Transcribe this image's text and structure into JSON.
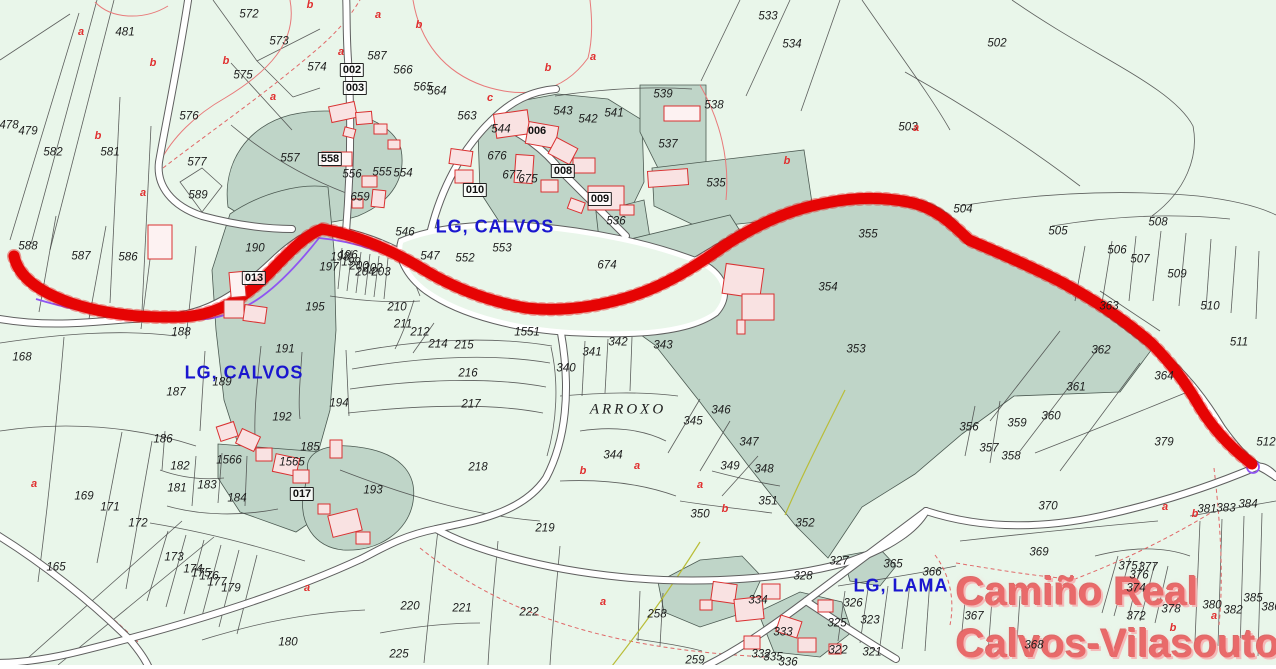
{
  "map": {
    "colors": {
      "background": "#e9f6ea",
      "parcel_dark": "#bfd5c8",
      "route_red": "#e60404",
      "gps_track_purple": "#8f55f2",
      "road_fill": "#ffffff",
      "parcel_label": "#1d1d1d",
      "subparcel_letter": "#e03030",
      "place_label_blue": "#1a16cf",
      "title_pink": "#e96a6a",
      "building_fill": "#f9e2e2",
      "building_stroke": "#d93131"
    },
    "place_labels": [
      {
        "text": "LG, CALVOS",
        "x": 495,
        "y": 227
      },
      {
        "text": "LG, CALVOS",
        "x": 244,
        "y": 373
      },
      {
        "text": "LG, LAMA",
        "x": 901,
        "y": 586
      }
    ],
    "area_label": {
      "text": "ARROXO",
      "x": 628,
      "y": 410
    },
    "title_overlay": {
      "line1": "Camiño Real",
      "line2": "Calvos-Vilasouto"
    },
    "parcel_labels": [
      {
        "t": "481",
        "x": 125,
        "y": 33
      },
      {
        "t": "572",
        "x": 249,
        "y": 15
      },
      {
        "t": "573",
        "x": 279,
        "y": 42
      },
      {
        "t": "575",
        "x": 243,
        "y": 76
      },
      {
        "t": "576",
        "x": 189,
        "y": 117
      },
      {
        "t": "577",
        "x": 197,
        "y": 163
      },
      {
        "t": "478",
        "x": 9,
        "y": 126
      },
      {
        "t": "479",
        "x": 28,
        "y": 132
      },
      {
        "t": "582",
        "x": 53,
        "y": 153
      },
      {
        "t": "581",
        "x": 110,
        "y": 153
      },
      {
        "t": "557",
        "x": 290,
        "y": 159
      },
      {
        "t": "587",
        "x": 377,
        "y": 57
      },
      {
        "t": "574",
        "x": 317,
        "y": 68
      },
      {
        "t": "566",
        "x": 403,
        "y": 71
      },
      {
        "t": "565",
        "x": 423,
        "y": 88
      },
      {
        "t": "564",
        "x": 437,
        "y": 92
      },
      {
        "t": "563",
        "x": 467,
        "y": 117
      },
      {
        "t": "544",
        "x": 501,
        "y": 130
      },
      {
        "t": "543",
        "x": 563,
        "y": 112
      },
      {
        "t": "542",
        "x": 588,
        "y": 120
      },
      {
        "t": "541",
        "x": 614,
        "y": 114
      },
      {
        "t": "539",
        "x": 663,
        "y": 95
      },
      {
        "t": "538",
        "x": 714,
        "y": 106
      },
      {
        "t": "537",
        "x": 668,
        "y": 145
      },
      {
        "t": "533",
        "x": 768,
        "y": 17
      },
      {
        "t": "534",
        "x": 792,
        "y": 45
      },
      {
        "t": "503",
        "x": 908,
        "y": 128
      },
      {
        "t": "502",
        "x": 997,
        "y": 44
      },
      {
        "t": "535",
        "x": 716,
        "y": 184
      },
      {
        "t": "536",
        "x": 616,
        "y": 222
      },
      {
        "t": "556",
        "x": 352,
        "y": 175
      },
      {
        "t": "555",
        "x": 382,
        "y": 173
      },
      {
        "t": "554",
        "x": 403,
        "y": 174
      },
      {
        "t": "659",
        "x": 360,
        "y": 198
      },
      {
        "t": "676",
        "x": 497,
        "y": 157
      },
      {
        "t": "677",
        "x": 512,
        "y": 176
      },
      {
        "t": "675",
        "x": 528,
        "y": 180
      },
      {
        "t": "546",
        "x": 405,
        "y": 233
      },
      {
        "t": "547",
        "x": 430,
        "y": 257
      },
      {
        "t": "552",
        "x": 465,
        "y": 259
      },
      {
        "t": "553",
        "x": 502,
        "y": 249
      },
      {
        "t": "674",
        "x": 607,
        "y": 266
      },
      {
        "t": "588",
        "x": 28,
        "y": 247
      },
      {
        "t": "587",
        "x": 81,
        "y": 257
      },
      {
        "t": "586",
        "x": 128,
        "y": 258
      },
      {
        "t": "589",
        "x": 198,
        "y": 196
      },
      {
        "t": "190",
        "x": 255,
        "y": 249
      },
      {
        "t": "188",
        "x": 181,
        "y": 333
      },
      {
        "t": "196",
        "x": 348,
        "y": 256
      },
      {
        "t": "197",
        "x": 329,
        "y": 268
      },
      {
        "t": "198",
        "x": 340,
        "y": 258
      },
      {
        "t": "199",
        "x": 351,
        "y": 263
      },
      {
        "t": "200",
        "x": 359,
        "y": 267
      },
      {
        "t": "204",
        "x": 365,
        "y": 273
      },
      {
        "t": "202",
        "x": 373,
        "y": 269
      },
      {
        "t": "203",
        "x": 381,
        "y": 273
      },
      {
        "t": "195",
        "x": 315,
        "y": 308
      },
      {
        "t": "210",
        "x": 397,
        "y": 308
      },
      {
        "t": "211",
        "x": 403,
        "y": 325
      },
      {
        "t": "212",
        "x": 420,
        "y": 333
      },
      {
        "t": "1551",
        "x": 527,
        "y": 333
      },
      {
        "t": "214",
        "x": 438,
        "y": 345
      },
      {
        "t": "215",
        "x": 464,
        "y": 346
      },
      {
        "t": "216",
        "x": 468,
        "y": 374
      },
      {
        "t": "217",
        "x": 471,
        "y": 405
      },
      {
        "t": "218",
        "x": 478,
        "y": 468
      },
      {
        "t": "194",
        "x": 339,
        "y": 404
      },
      {
        "t": "193",
        "x": 373,
        "y": 491
      },
      {
        "t": "168",
        "x": 22,
        "y": 358
      },
      {
        "t": "187",
        "x": 176,
        "y": 393
      },
      {
        "t": "189",
        "x": 222,
        "y": 383
      },
      {
        "t": "191",
        "x": 285,
        "y": 350
      },
      {
        "t": "192",
        "x": 282,
        "y": 418
      },
      {
        "t": "185",
        "x": 310,
        "y": 448
      },
      {
        "t": "186",
        "x": 163,
        "y": 440
      },
      {
        "t": "182",
        "x": 180,
        "y": 467
      },
      {
        "t": "181",
        "x": 177,
        "y": 489
      },
      {
        "t": "183",
        "x": 207,
        "y": 486
      },
      {
        "t": "184",
        "x": 237,
        "y": 499
      },
      {
        "t": "1566",
        "x": 229,
        "y": 461
      },
      {
        "t": "1565",
        "x": 292,
        "y": 463
      },
      {
        "t": "169",
        "x": 84,
        "y": 497
      },
      {
        "t": "171",
        "x": 110,
        "y": 508
      },
      {
        "t": "172",
        "x": 138,
        "y": 524
      },
      {
        "t": "165",
        "x": 56,
        "y": 568
      },
      {
        "t": "173",
        "x": 174,
        "y": 558
      },
      {
        "t": "174",
        "x": 193,
        "y": 570
      },
      {
        "t": "175",
        "x": 201,
        "y": 574
      },
      {
        "t": "176",
        "x": 209,
        "y": 577
      },
      {
        "t": "177",
        "x": 217,
        "y": 583
      },
      {
        "t": "179",
        "x": 231,
        "y": 589
      },
      {
        "t": "180",
        "x": 288,
        "y": 643
      },
      {
        "t": "219",
        "x": 545,
        "y": 529
      },
      {
        "t": "220",
        "x": 410,
        "y": 607
      },
      {
        "t": "221",
        "x": 462,
        "y": 609
      },
      {
        "t": "222",
        "x": 529,
        "y": 613
      },
      {
        "t": "225",
        "x": 399,
        "y": 655
      },
      {
        "t": "340",
        "x": 566,
        "y": 369
      },
      {
        "t": "341",
        "x": 592,
        "y": 353
      },
      {
        "t": "342",
        "x": 618,
        "y": 343
      },
      {
        "t": "343",
        "x": 663,
        "y": 346
      },
      {
        "t": "344",
        "x": 613,
        "y": 456
      },
      {
        "t": "345",
        "x": 693,
        "y": 422
      },
      {
        "t": "346",
        "x": 721,
        "y": 411
      },
      {
        "t": "347",
        "x": 749,
        "y": 443
      },
      {
        "t": "348",
        "x": 764,
        "y": 470
      },
      {
        "t": "349",
        "x": 730,
        "y": 467
      },
      {
        "t": "350",
        "x": 700,
        "y": 515
      },
      {
        "t": "351",
        "x": 768,
        "y": 502
      },
      {
        "t": "352",
        "x": 805,
        "y": 524
      },
      {
        "t": "353",
        "x": 856,
        "y": 350
      },
      {
        "t": "354",
        "x": 828,
        "y": 288
      },
      {
        "t": "355",
        "x": 868,
        "y": 235
      },
      {
        "t": "504",
        "x": 963,
        "y": 210
      },
      {
        "t": "505",
        "x": 1058,
        "y": 232
      },
      {
        "t": "506",
        "x": 1117,
        "y": 251
      },
      {
        "t": "507",
        "x": 1140,
        "y": 260
      },
      {
        "t": "508",
        "x": 1158,
        "y": 223
      },
      {
        "t": "509",
        "x": 1177,
        "y": 275
      },
      {
        "t": "510",
        "x": 1210,
        "y": 307
      },
      {
        "t": "511",
        "x": 1239,
        "y": 343
      },
      {
        "t": "512",
        "x": 1266,
        "y": 443
      },
      {
        "t": "363",
        "x": 1109,
        "y": 307
      },
      {
        "t": "364",
        "x": 1164,
        "y": 377
      },
      {
        "t": "379",
        "x": 1164,
        "y": 443
      },
      {
        "t": "362",
        "x": 1101,
        "y": 351
      },
      {
        "t": "361",
        "x": 1076,
        "y": 388
      },
      {
        "t": "360",
        "x": 1051,
        "y": 417
      },
      {
        "t": "359",
        "x": 1017,
        "y": 424
      },
      {
        "t": "356",
        "x": 969,
        "y": 428
      },
      {
        "t": "357",
        "x": 989,
        "y": 449
      },
      {
        "t": "358",
        "x": 1011,
        "y": 457
      },
      {
        "t": "370",
        "x": 1048,
        "y": 507
      },
      {
        "t": "369",
        "x": 1039,
        "y": 553
      },
      {
        "t": "258",
        "x": 657,
        "y": 615
      },
      {
        "t": "259",
        "x": 695,
        "y": 661
      },
      {
        "t": "327",
        "x": 839,
        "y": 562
      },
      {
        "t": "328",
        "x": 803,
        "y": 577
      },
      {
        "t": "365",
        "x": 893,
        "y": 565
      },
      {
        "t": "366",
        "x": 932,
        "y": 573
      },
      {
        "t": "326",
        "x": 853,
        "y": 604
      },
      {
        "t": "323",
        "x": 870,
        "y": 621
      },
      {
        "t": "325",
        "x": 837,
        "y": 624
      },
      {
        "t": "322",
        "x": 838,
        "y": 651
      },
      {
        "t": "321",
        "x": 872,
        "y": 653
      },
      {
        "t": "334",
        "x": 758,
        "y": 601
      },
      {
        "t": "333",
        "x": 783,
        "y": 633
      },
      {
        "t": "332",
        "x": 761,
        "y": 655
      },
      {
        "t": "335",
        "x": 773,
        "y": 658
      },
      {
        "t": "336",
        "x": 788,
        "y": 663
      },
      {
        "t": "367",
        "x": 974,
        "y": 617
      },
      {
        "t": "368",
        "x": 1034,
        "y": 646
      },
      {
        "t": "375",
        "x": 1128,
        "y": 567
      },
      {
        "t": "377",
        "x": 1148,
        "y": 568
      },
      {
        "t": "376",
        "x": 1139,
        "y": 576
      },
      {
        "t": "374",
        "x": 1136,
        "y": 589
      },
      {
        "t": "378",
        "x": 1171,
        "y": 610
      },
      {
        "t": "372",
        "x": 1136,
        "y": 617
      },
      {
        "t": "380",
        "x": 1212,
        "y": 606
      },
      {
        "t": "382",
        "x": 1233,
        "y": 611
      },
      {
        "t": "385",
        "x": 1253,
        "y": 599
      },
      {
        "t": "386",
        "x": 1271,
        "y": 608
      },
      {
        "t": "381",
        "x": 1207,
        "y": 510
      },
      {
        "t": "383",
        "x": 1226,
        "y": 509
      },
      {
        "t": "384",
        "x": 1248,
        "y": 505
      }
    ],
    "building_labels": [
      {
        "t": "002",
        "x": 352,
        "y": 70
      },
      {
        "t": "003",
        "x": 355,
        "y": 88
      },
      {
        "t": "010",
        "x": 475,
        "y": 190
      },
      {
        "t": "008",
        "x": 563,
        "y": 171
      },
      {
        "t": "009",
        "x": 600,
        "y": 199
      },
      {
        "t": "013",
        "x": 254,
        "y": 278
      },
      {
        "t": "017",
        "x": 302,
        "y": 494
      },
      {
        "t": "558",
        "x": 330,
        "y": 159
      },
      {
        "t": "006",
        "x": 537,
        "y": 131,
        "boxed": false
      }
    ],
    "subparcel_letters": [
      {
        "t": "a",
        "x": 81,
        "y": 32
      },
      {
        "t": "b",
        "x": 153,
        "y": 63
      },
      {
        "t": "b",
        "x": 226,
        "y": 61
      },
      {
        "t": "a",
        "x": 273,
        "y": 97
      },
      {
        "t": "b",
        "x": 98,
        "y": 136
      },
      {
        "t": "b",
        "x": 310,
        "y": 5
      },
      {
        "t": "a",
        "x": 378,
        "y": 15
      },
      {
        "t": "b",
        "x": 419,
        "y": 25
      },
      {
        "t": "a",
        "x": 341,
        "y": 52
      },
      {
        "t": "b",
        "x": 548,
        "y": 68
      },
      {
        "t": "c",
        "x": 490,
        "y": 98
      },
      {
        "t": "a",
        "x": 593,
        "y": 57
      },
      {
        "t": "b",
        "x": 787,
        "y": 161
      },
      {
        "t": "a",
        "x": 916,
        "y": 128
      },
      {
        "t": "a",
        "x": 143,
        "y": 193
      },
      {
        "t": "a",
        "x": 34,
        "y": 484
      },
      {
        "t": "a",
        "x": 307,
        "y": 588
      },
      {
        "t": "b",
        "x": 583,
        "y": 471
      },
      {
        "t": "a",
        "x": 637,
        "y": 466
      },
      {
        "t": "a",
        "x": 700,
        "y": 485
      },
      {
        "t": "b",
        "x": 725,
        "y": 509
      },
      {
        "t": "a",
        "x": 603,
        "y": 602
      },
      {
        "t": "a",
        "x": 1165,
        "y": 507
      },
      {
        "t": "b",
        "x": 1195,
        "y": 514
      },
      {
        "t": "a",
        "x": 1214,
        "y": 616
      },
      {
        "t": "b",
        "x": 1173,
        "y": 628
      }
    ]
  }
}
